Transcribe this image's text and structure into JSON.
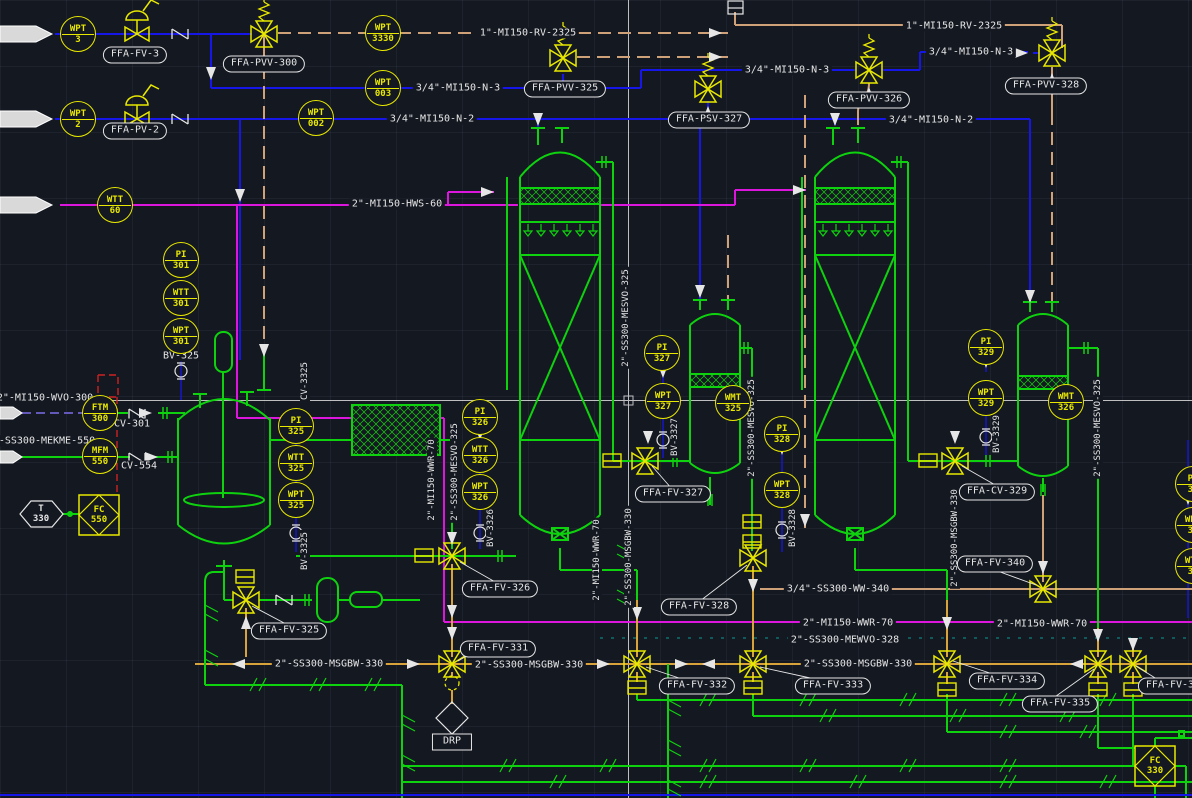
{
  "drawing": {
    "type": "P&ID piping and instrumentation di agram (CAD model space)",
    "colors": {
      "background": "#141821",
      "process_green": "#0fd20f",
      "utility_blue": "#1616e8",
      "hot_water_magenta": "#dd16dd",
      "relief_tan": "#cfa178",
      "drain_orange": "#d9a33c",
      "symbol_yellow": "#e8e800",
      "text_white": "#e6e6e6",
      "signal_red": "#cc2222",
      "signal_teal": "#0f7070",
      "dashed_purple": "#7060d0"
    }
  },
  "instruments": [
    {
      "line1": "WPT",
      "line2": "3",
      "x": 78,
      "y": 34
    },
    {
      "line1": "WPT",
      "line2": "2",
      "x": 78,
      "y": 119
    },
    {
      "line1": "WPT",
      "line2": "3330",
      "x": 383,
      "y": 33
    },
    {
      "line1": "WPT",
      "line2": "003",
      "x": 383,
      "y": 88
    },
    {
      "line1": "WPT",
      "line2": "002",
      "x": 316,
      "y": 118
    },
    {
      "line1": "WTT",
      "line2": "60",
      "x": 115,
      "y": 205
    },
    {
      "line1": "PI",
      "line2": "301",
      "x": 181,
      "y": 260
    },
    {
      "line1": "WTT",
      "line2": "301",
      "x": 181,
      "y": 298
    },
    {
      "line1": "WPT",
      "line2": "301",
      "x": 181,
      "y": 336
    },
    {
      "line1": "FTM",
      "line2": "300",
      "x": 100,
      "y": 413
    },
    {
      "line1": "MFM",
      "line2": "550",
      "x": 100,
      "y": 456
    },
    {
      "line1": "PI",
      "line2": "325",
      "x": 296,
      "y": 426
    },
    {
      "line1": "WTT",
      "line2": "325",
      "x": 296,
      "y": 463
    },
    {
      "line1": "WPT",
      "line2": "325",
      "x": 296,
      "y": 500
    },
    {
      "line1": "PI",
      "line2": "326",
      "x": 480,
      "y": 417
    },
    {
      "line1": "WTT",
      "line2": "326",
      "x": 480,
      "y": 455
    },
    {
      "line1": "WPT",
      "line2": "326",
      "x": 480,
      "y": 492
    },
    {
      "line1": "PI",
      "line2": "327",
      "x": 662,
      "y": 353
    },
    {
      "line1": "WPT",
      "line2": "327",
      "x": 663,
      "y": 401
    },
    {
      "line1": "WMT",
      "line2": "325",
      "x": 733,
      "y": 403
    },
    {
      "line1": "PI",
      "line2": "328",
      "x": 782,
      "y": 434
    },
    {
      "line1": "WPT",
      "line2": "328",
      "x": 782,
      "y": 490
    },
    {
      "line1": "PI",
      "line2": "329",
      "x": 986,
      "y": 347
    },
    {
      "line1": "WPT",
      "line2": "329",
      "x": 986,
      "y": 398
    },
    {
      "line1": "WMT",
      "line2": "326",
      "x": 1066,
      "y": 402
    },
    {
      "line1": "PI",
      "line2": "33",
      "x": 1193,
      "y": 484
    },
    {
      "line1": "WPT",
      "line2": "33",
      "x": 1193,
      "y": 525
    },
    {
      "line1": "WTT",
      "line2": "33",
      "x": 1193,
      "y": 566
    }
  ],
  "valve_tags": [
    {
      "text": "FFA-FV-3",
      "x": 135,
      "y": 55
    },
    {
      "text": "FFA-PVV-300",
      "x": 264,
      "y": 64
    },
    {
      "text": "FFA-PV-2",
      "x": 135,
      "y": 131
    },
    {
      "text": "FFA-PVV-325",
      "x": 565,
      "y": 89
    },
    {
      "text": "FFA-PSV-327",
      "x": 709,
      "y": 120
    },
    {
      "text": "FFA-PVV-326",
      "x": 869,
      "y": 100
    },
    {
      "text": "FFA-PVV-328",
      "x": 1046,
      "y": 86
    },
    {
      "text": "FFA-FV-325",
      "x": 289,
      "y": 631
    },
    {
      "text": "FFA-FV-326",
      "x": 500,
      "y": 589
    },
    {
      "text": "FFA-FV-327",
      "x": 673,
      "y": 494
    },
    {
      "text": "FFA-CV-329",
      "x": 997,
      "y": 492
    },
    {
      "text": "FFA-FV-328",
      "x": 699,
      "y": 607
    },
    {
      "text": "FFA-FV-331",
      "x": 498,
      "y": 649
    },
    {
      "text": "FFA-FV-332",
      "x": 697,
      "y": 686
    },
    {
      "text": "FFA-FV-333",
      "x": 833,
      "y": 686
    },
    {
      "text": "FFA-FV-334",
      "x": 1007,
      "y": 681
    },
    {
      "text": "FFA-FV-335",
      "x": 1060,
      "y": 704
    },
    {
      "text": "FFA-FV-340",
      "x": 995,
      "y": 564
    },
    {
      "text": "FFA-FV-3",
      "x": 1170,
      "y": 686
    }
  ],
  "line_labels": [
    {
      "text": "1\"-MI150-RV-2325",
      "x": 528,
      "y": 33
    },
    {
      "text": "1\"-MI150-RV-2325",
      "x": 954,
      "y": 26
    },
    {
      "text": "3/4\"-MI150-N-3",
      "x": 458,
      "y": 88
    },
    {
      "text": "3/4\"-MI150-N-3",
      "x": 787,
      "y": 70
    },
    {
      "text": "3/4\"-MI150-N-3",
      "x": 971,
      "y": 52
    },
    {
      "text": "3/4\"-MI150-N-2",
      "x": 432,
      "y": 119
    },
    {
      "text": "3/4\"-MI150-N-2",
      "x": 931,
      "y": 120
    },
    {
      "text": "2\"-MI150-HWS-60",
      "x": 397,
      "y": 204
    },
    {
      "text": "2\"-MI150-WVO-300",
      "x": 45,
      "y": 398
    },
    {
      "text": "-SS300-MEKME-550",
      "x": 47,
      "y": 441
    },
    {
      "text": "BV-325",
      "x": 181,
      "y": 356
    },
    {
      "text": "CV-301",
      "x": 132,
      "y": 424
    },
    {
      "text": "CV-554",
      "x": 139,
      "y": 466
    },
    {
      "text": "2\"-SS300-MSGBW-330",
      "x": 329,
      "y": 664
    },
    {
      "text": "2\"-SS300-MSGBW-330",
      "x": 529,
      "y": 665
    },
    {
      "text": "2\"-SS300-MSGBW-330",
      "x": 858,
      "y": 664
    },
    {
      "text": "2\"-MI150-WWR-70",
      "x": 848,
      "y": 623
    },
    {
      "text": "2\"-MI150-WWR-70",
      "x": 1042,
      "y": 624
    },
    {
      "text": "3/4\"-SS300-WW-340",
      "x": 838,
      "y": 589
    },
    {
      "text": "2\"-SS300-MEWVO-328",
      "x": 845,
      "y": 640
    }
  ],
  "vertical_labels": [
    {
      "text": "CV-3325",
      "x": 305,
      "y": 381
    },
    {
      "text": "BV-3325",
      "x": 305,
      "y": 551
    },
    {
      "text": "BV-3326",
      "x": 491,
      "y": 528
    },
    {
      "text": "BV-3327",
      "x": 675,
      "y": 437
    },
    {
      "text": "BV-3328",
      "x": 793,
      "y": 528
    },
    {
      "text": "BV-3329",
      "x": 997,
      "y": 434
    },
    {
      "text": "2\"-MI150-WWR-70",
      "x": 432,
      "y": 480
    },
    {
      "text": "2\"-SS300-MESVO-325",
      "x": 455,
      "y": 472
    },
    {
      "text": "2\"-SS300-MESVO-325",
      "x": 626,
      "y": 318
    },
    {
      "text": "2\"-SS300-MSGBW-330",
      "x": 629,
      "y": 557
    },
    {
      "text": "2\"-MI150-WWR-70",
      "x": 597,
      "y": 560
    },
    {
      "text": "2\"-SS300-MESVO-325",
      "x": 752,
      "y": 428
    },
    {
      "text": "2\"-SS300-MESVO-325",
      "x": 1098,
      "y": 428
    },
    {
      "text": "2\"-SS300-MSGBW-330",
      "x": 955,
      "y": 538
    }
  ],
  "special_labels": [
    {
      "line1": "T",
      "line2": "330",
      "x": 41,
      "y": 514,
      "color": "#e6e6e6"
    },
    {
      "line1": "FC",
      "line2": "550",
      "x": 99,
      "y": 515,
      "color": "#e8e800"
    },
    {
      "line1": "FC",
      "line2": "330",
      "x": 1155,
      "y": 766,
      "color": "#e8e800"
    },
    {
      "line1": "DRP",
      "line2": "",
      "x": 452,
      "y": 742,
      "color": "#e6e6e6",
      "shape": "rect"
    }
  ]
}
